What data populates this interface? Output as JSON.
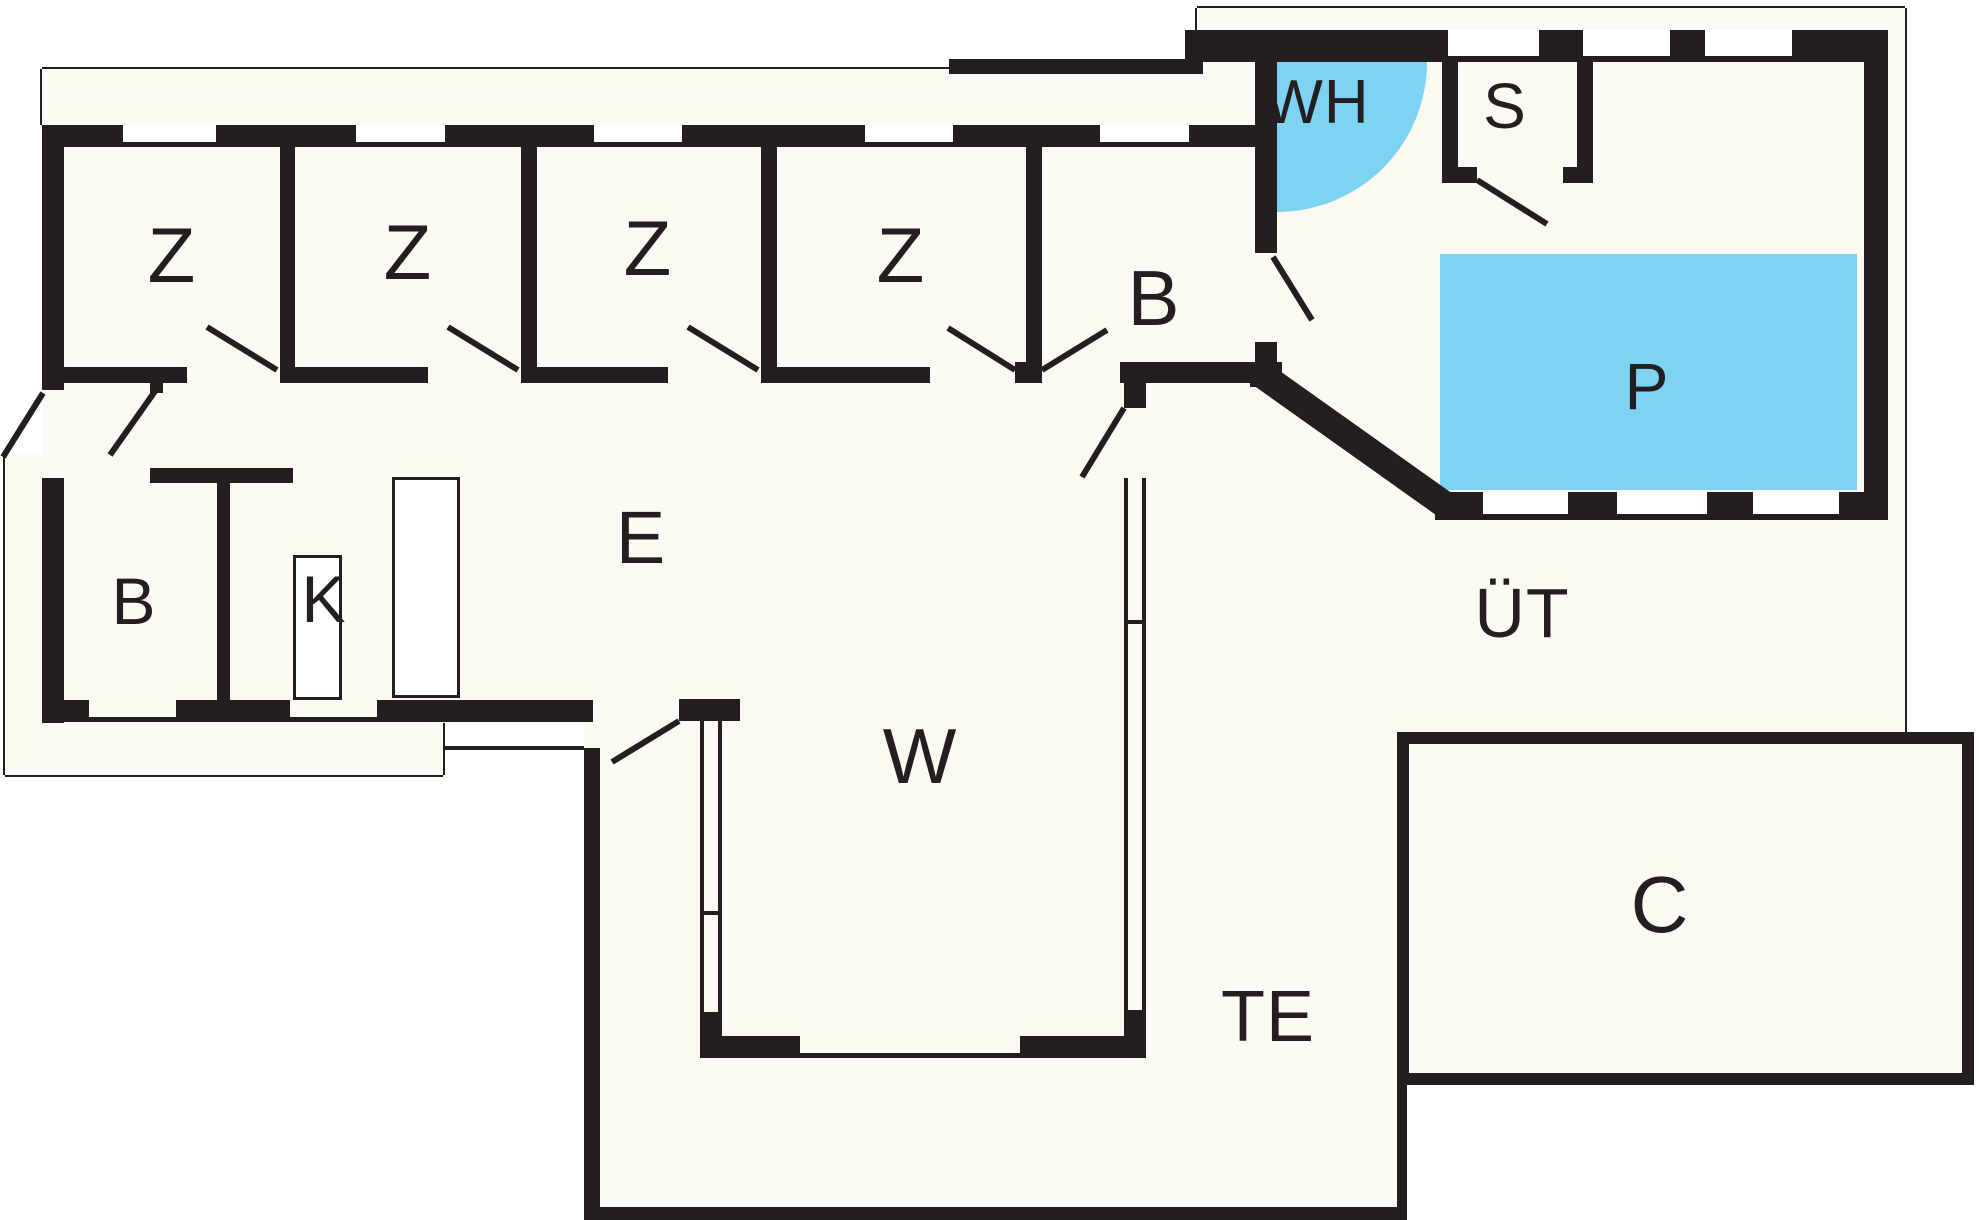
{
  "title": "Floor plan",
  "colors": {
    "wall": "#231f20",
    "floor": "#fbfaf2",
    "water": "#7ed3f2",
    "outside": "#ffffff",
    "thin_line": "#231f20"
  },
  "labels": [
    {
      "name": "room-label-z1",
      "text": "Z",
      "x": 172,
      "y": 255,
      "size": 78
    },
    {
      "name": "room-label-z2",
      "text": "Z",
      "x": 408,
      "y": 252,
      "size": 78
    },
    {
      "name": "room-label-z3",
      "text": "Z",
      "x": 648,
      "y": 248,
      "size": 78
    },
    {
      "name": "room-label-z4",
      "text": "Z",
      "x": 901,
      "y": 255,
      "size": 78
    },
    {
      "name": "room-label-b-wing",
      "text": "B",
      "x": 1154,
      "y": 298,
      "size": 78
    },
    {
      "name": "room-label-wh",
      "text": "WH",
      "x": 1317,
      "y": 103,
      "size": 62
    },
    {
      "name": "room-label-s",
      "text": "S",
      "x": 1505,
      "y": 106,
      "size": 64
    },
    {
      "name": "room-label-p",
      "text": "P",
      "x": 1647,
      "y": 386,
      "size": 66
    },
    {
      "name": "room-label-ut",
      "text": "ÜT",
      "x": 1522,
      "y": 613,
      "size": 70
    },
    {
      "name": "room-label-e",
      "text": "E",
      "x": 641,
      "y": 538,
      "size": 74
    },
    {
      "name": "room-label-b-small",
      "text": "B",
      "x": 134,
      "y": 601,
      "size": 66
    },
    {
      "name": "room-label-k",
      "text": "K",
      "x": 324,
      "y": 599,
      "size": 66
    },
    {
      "name": "room-label-w",
      "text": "W",
      "x": 920,
      "y": 756,
      "size": 78
    },
    {
      "name": "room-label-te",
      "text": "TE",
      "x": 1268,
      "y": 1017,
      "size": 72
    },
    {
      "name": "room-label-c",
      "text": "C",
      "x": 1660,
      "y": 905,
      "size": 80
    }
  ],
  "floor_areas": [
    {
      "name": "floor-wing",
      "x": 42,
      "y": 69,
      "w": 1213,
      "h": 654
    },
    {
      "name": "floor-porch",
      "x": 949,
      "y": 59,
      "w": 306,
      "h": 88
    },
    {
      "name": "floor-pool-house",
      "x": 1197,
      "y": 8,
      "w": 708,
      "h": 724
    },
    {
      "name": "floor-terrace-te",
      "x": 584,
      "y": 390,
      "w": 813,
      "h": 817
    },
    {
      "name": "floor-paving-left",
      "x": 5,
      "y": 455,
      "w": 37,
      "h": 320
    },
    {
      "name": "floor-paving-bottom",
      "x": 5,
      "y": 722,
      "w": 438,
      "h": 53
    },
    {
      "name": "floor-c-building",
      "x": 1409,
      "y": 744,
      "w": 553,
      "h": 329
    }
  ],
  "water_features": [
    {
      "name": "pool",
      "x": 1440,
      "y": 254,
      "w": 417,
      "h": 236
    }
  ],
  "whirlpool": {
    "name": "whirlpool-quarter-circle",
    "cx": 1277,
    "cy": 62,
    "r": 150
  },
  "walls": [
    {
      "name": "wall-wing-top",
      "x": 42,
      "y": 125,
      "w": 1213,
      "h": 22
    },
    {
      "name": "wall-wing-left-upper",
      "x": 42,
      "y": 125,
      "w": 22,
      "h": 265
    },
    {
      "name": "wall-wing-left-lower",
      "x": 42,
      "y": 478,
      "w": 22,
      "h": 245
    },
    {
      "name": "wall-partition-z1-z2",
      "x": 280,
      "y": 147,
      "w": 15,
      "h": 236
    },
    {
      "name": "wall-partition-z2-z3",
      "x": 521,
      "y": 147,
      "w": 16,
      "h": 236
    },
    {
      "name": "wall-partition-z3-z4",
      "x": 761,
      "y": 147,
      "w": 16,
      "h": 236
    },
    {
      "name": "wall-partition-z4-b",
      "x": 1026,
      "y": 147,
      "w": 16,
      "h": 236
    },
    {
      "name": "wall-corridor-seg1",
      "x": 42,
      "y": 367,
      "w": 145,
      "h": 16
    },
    {
      "name": "wall-corridor-seg2",
      "x": 280,
      "y": 367,
      "w": 148,
      "h": 16
    },
    {
      "name": "wall-corridor-seg3",
      "x": 521,
      "y": 367,
      "w": 147,
      "h": 16
    },
    {
      "name": "wall-corridor-seg4",
      "x": 761,
      "y": 367,
      "w": 169,
      "h": 16
    },
    {
      "name": "wall-vdoor-post",
      "x": 1015,
      "y": 362,
      "w": 27,
      "h": 21
    },
    {
      "name": "wall-broom-bottom-bar",
      "x": 1120,
      "y": 362,
      "w": 162,
      "h": 21
    },
    {
      "name": "wall-bottom-seg1",
      "x": 42,
      "y": 700,
      "w": 47,
      "h": 22
    },
    {
      "name": "wall-bottom-seg2",
      "x": 176,
      "y": 700,
      "w": 114,
      "h": 22
    },
    {
      "name": "wall-bottom-seg3",
      "x": 377,
      "y": 700,
      "w": 216,
      "h": 22
    },
    {
      "name": "wall-bottom-sill1",
      "x": 89,
      "y": 717,
      "w": 87,
      "h": 5
    },
    {
      "name": "wall-bottom-sill2",
      "x": 290,
      "y": 717,
      "w": 87,
      "h": 5
    },
    {
      "name": "wall-e-door-post",
      "x": 679,
      "y": 699,
      "w": 61,
      "h": 22
    },
    {
      "name": "wall-b-small-right",
      "x": 217,
      "y": 480,
      "w": 13,
      "h": 220
    },
    {
      "name": "wall-k-top-bar",
      "x": 150,
      "y": 468,
      "w": 143,
      "h": 15
    },
    {
      "name": "wall-b-small-door-post",
      "x": 150,
      "y": 380,
      "w": 13,
      "h": 13
    },
    {
      "name": "wall-w-left-line-a",
      "x": 700,
      "y": 721,
      "w": 4,
      "h": 291
    },
    {
      "name": "wall-w-left-line-b",
      "x": 718,
      "y": 721,
      "w": 4,
      "h": 291
    },
    {
      "name": "wall-w-left-tick",
      "x": 700,
      "y": 911,
      "w": 22,
      "h": 4
    },
    {
      "name": "wall-w-left-block",
      "x": 700,
      "y": 1012,
      "w": 22,
      "h": 46
    },
    {
      "name": "wall-w-right-top-block",
      "x": 1124,
      "y": 382,
      "w": 22,
      "h": 26
    },
    {
      "name": "wall-w-right-line-a",
      "x": 1124,
      "y": 478,
      "w": 4,
      "h": 532
    },
    {
      "name": "wall-w-right-line-b",
      "x": 1142,
      "y": 478,
      "w": 4,
      "h": 532
    },
    {
      "name": "wall-w-right-tick",
      "x": 1124,
      "y": 620,
      "w": 22,
      "h": 4
    },
    {
      "name": "wall-w-right-block",
      "x": 1124,
      "y": 1010,
      "w": 22,
      "h": 48
    },
    {
      "name": "wall-w-bottom-seg1",
      "x": 722,
      "y": 1036,
      "w": 78,
      "h": 22
    },
    {
      "name": "wall-w-bottom-seg2",
      "x": 1020,
      "y": 1036,
      "w": 104,
      "h": 22
    },
    {
      "name": "wall-w-bottom-sill",
      "x": 800,
      "y": 1053,
      "w": 220,
      "h": 5
    },
    {
      "name": "wall-te-left",
      "x": 584,
      "y": 748,
      "w": 16,
      "h": 472
    },
    {
      "name": "wall-te-bottom",
      "x": 584,
      "y": 1207,
      "w": 822,
      "h": 13
    },
    {
      "name": "wall-te-right",
      "x": 1397,
      "y": 1073,
      "w": 10,
      "h": 147
    },
    {
      "name": "wall-c-top",
      "x": 1397,
      "y": 732,
      "w": 577,
      "h": 12
    },
    {
      "name": "wall-c-left",
      "x": 1397,
      "y": 732,
      "w": 12,
      "h": 353
    },
    {
      "name": "wall-c-right",
      "x": 1962,
      "y": 732,
      "w": 12,
      "h": 353
    },
    {
      "name": "wall-c-bottom",
      "x": 1397,
      "y": 1073,
      "w": 577,
      "h": 12
    },
    {
      "name": "wall-porch-top-bar",
      "x": 949,
      "y": 59,
      "w": 248,
      "h": 15
    },
    {
      "name": "wall-porch-riser",
      "x": 1185,
      "y": 30,
      "w": 18,
      "h": 44
    },
    {
      "name": "wall-pool-house-top",
      "x": 1197,
      "y": 30,
      "w": 691,
      "h": 32
    },
    {
      "name": "wall-pool-house-right",
      "x": 1864,
      "y": 30,
      "w": 24,
      "h": 490
    },
    {
      "name": "wall-pool-house-bottom",
      "x": 1435,
      "y": 492,
      "w": 453,
      "h": 28
    },
    {
      "name": "wall-pool-house-left-upper",
      "x": 1255,
      "y": 30,
      "w": 22,
      "h": 223
    },
    {
      "name": "wall-pool-house-left-stub",
      "x": 1255,
      "y": 342,
      "w": 22,
      "h": 21
    },
    {
      "name": "wall-pool-house-corner-block",
      "x": 1250,
      "y": 363,
      "w": 32,
      "h": 24
    },
    {
      "name": "wall-s-room-left",
      "x": 1442,
      "y": 62,
      "w": 16,
      "h": 121
    },
    {
      "name": "wall-s-room-right",
      "x": 1577,
      "y": 62,
      "w": 16,
      "h": 121
    },
    {
      "name": "wall-s-room-bottom-left",
      "x": 1442,
      "y": 167,
      "w": 35,
      "h": 16
    },
    {
      "name": "wall-s-room-bottom-right",
      "x": 1563,
      "y": 167,
      "w": 30,
      "h": 16
    }
  ],
  "window_gaps": [
    {
      "name": "window-z1",
      "x": 123,
      "y": 125,
      "w": 93,
      "h": 17
    },
    {
      "name": "window-z2",
      "x": 356,
      "y": 125,
      "w": 89,
      "h": 17
    },
    {
      "name": "window-z3",
      "x": 594,
      "y": 125,
      "w": 88,
      "h": 17
    },
    {
      "name": "window-z4",
      "x": 865,
      "y": 125,
      "w": 88,
      "h": 17
    },
    {
      "name": "window-b-wing",
      "x": 1100,
      "y": 125,
      "w": 89,
      "h": 17
    },
    {
      "name": "window-pool-top-1",
      "x": 1448,
      "y": 30,
      "w": 91,
      "h": 26
    },
    {
      "name": "window-pool-top-2",
      "x": 1583,
      "y": 30,
      "w": 87,
      "h": 26
    },
    {
      "name": "window-pool-top-3",
      "x": 1705,
      "y": 30,
      "w": 87,
      "h": 26
    },
    {
      "name": "window-pool-bottom-1",
      "x": 1483,
      "y": 492,
      "w": 85,
      "h": 22
    },
    {
      "name": "window-pool-bottom-2",
      "x": 1617,
      "y": 492,
      "w": 90,
      "h": 22
    },
    {
      "name": "window-pool-bottom-3",
      "x": 1753,
      "y": 492,
      "w": 86,
      "h": 22
    }
  ],
  "fixtures": [
    {
      "name": "kitchen-counter-1",
      "x": 293,
      "y": 555,
      "w": 49,
      "h": 145
    },
    {
      "name": "kitchen-counter-2",
      "x": 392,
      "y": 477,
      "w": 68,
      "h": 221
    }
  ],
  "thin_outlines": [
    {
      "name": "eave-line-top",
      "x1": 42,
      "y1": 69,
      "x2": 949,
      "y2": 69
    },
    {
      "name": "eave-line-left",
      "x1": 42,
      "y1": 69,
      "x2": 42,
      "y2": 125
    },
    {
      "name": "pool-house-outline-top",
      "x1": 1197,
      "y1": 8,
      "x2": 1905,
      "y2": 8
    },
    {
      "name": "pool-house-outline-right",
      "x1": 1905,
      "y1": 8,
      "x2": 1905,
      "y2": 732
    },
    {
      "name": "pool-house-outline-join",
      "x1": 1197,
      "y1": 8,
      "x2": 1197,
      "y2": 30
    },
    {
      "name": "paving-line-left",
      "x1": 5,
      "y1": 455,
      "x2": 5,
      "y2": 775
    },
    {
      "name": "paving-line-bottom",
      "x1": 5,
      "y1": 775,
      "x2": 443,
      "y2": 775
    },
    {
      "name": "paving-line-step",
      "x1": 443,
      "y1": 775,
      "x2": 443,
      "y2": 722
    },
    {
      "name": "paving-line-e-south",
      "x1": 443,
      "y1": 748,
      "x2": 590,
      "y2": 748
    }
  ],
  "oblique_wall": {
    "name": "wall-pool-house-oblique",
    "x1": 1258,
    "y1": 372,
    "x2": 1448,
    "y2": 507,
    "width": 27
  },
  "door_swings": [
    {
      "name": "door-entry-exterior",
      "x1": 3,
      "y1": 457,
      "x2": 43,
      "y2": 393
    },
    {
      "name": "door-b-small",
      "x1": 110,
      "y1": 455,
      "x2": 158,
      "y2": 387
    },
    {
      "name": "door-z1",
      "x1": 277,
      "y1": 370,
      "x2": 207,
      "y2": 327
    },
    {
      "name": "door-z2",
      "x1": 518,
      "y1": 370,
      "x2": 448,
      "y2": 327
    },
    {
      "name": "door-z3",
      "x1": 758,
      "y1": 370,
      "x2": 688,
      "y2": 327
    },
    {
      "name": "door-z4",
      "x1": 1015,
      "y1": 370,
      "x2": 948,
      "y2": 328
    },
    {
      "name": "door-b-wing",
      "x1": 1042,
      "y1": 370,
      "x2": 1107,
      "y2": 330
    },
    {
      "name": "door-e-south",
      "x1": 679,
      "y1": 721,
      "x2": 612,
      "y2": 762
    },
    {
      "name": "door-e-east",
      "x1": 1124,
      "y1": 408,
      "x2": 1082,
      "y2": 477
    },
    {
      "name": "door-pool-house",
      "x1": 1273,
      "y1": 257,
      "x2": 1312,
      "y2": 320
    },
    {
      "name": "door-s-room",
      "x1": 1477,
      "y1": 180,
      "x2": 1547,
      "y2": 224
    }
  ]
}
